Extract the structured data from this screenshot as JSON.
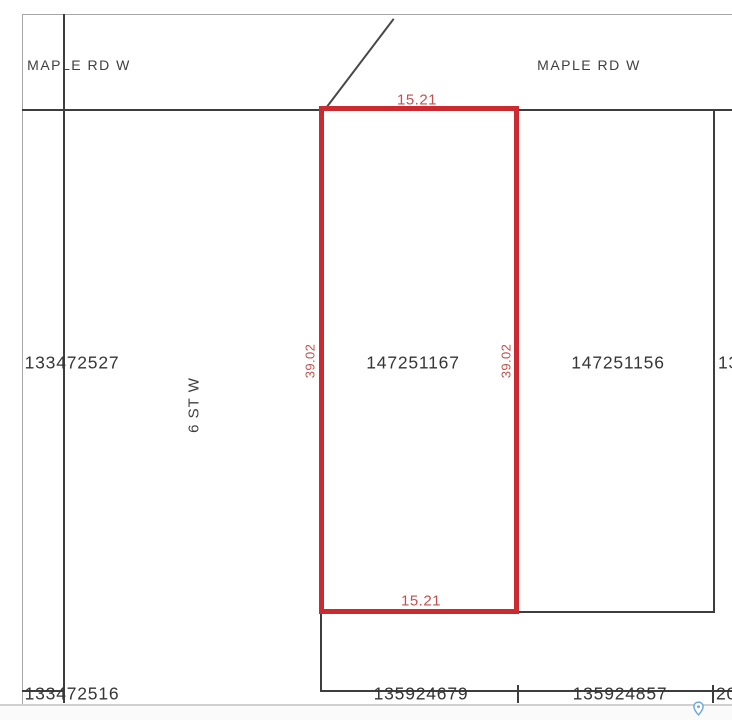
{
  "map": {
    "streets": {
      "maple_rd_left": "MAPLE RD W",
      "maple_rd_right": "MAPLE RD W",
      "sixth_st": "6 ST W"
    },
    "selected_parcel": {
      "id": "147251167",
      "frontage_top": "15.21",
      "frontage_bottom": "15.21",
      "depth_left": "39.02",
      "depth_right": "39.02"
    },
    "parcels": {
      "west": "133472527",
      "east": "147251156",
      "east_edge_clipped": "13",
      "south_west": "133472516",
      "south_center": "135924679",
      "south_east": "135924857",
      "south_edge_clipped": "20"
    },
    "icons": {
      "pin": "map-pin-icon"
    },
    "colors": {
      "highlight": "#cb2b30",
      "dimension": "#c2504e",
      "line": "#3d3d3d",
      "border": "#a6a6a6",
      "text": "#363636",
      "pin_blue": "#6fa8dc"
    }
  }
}
